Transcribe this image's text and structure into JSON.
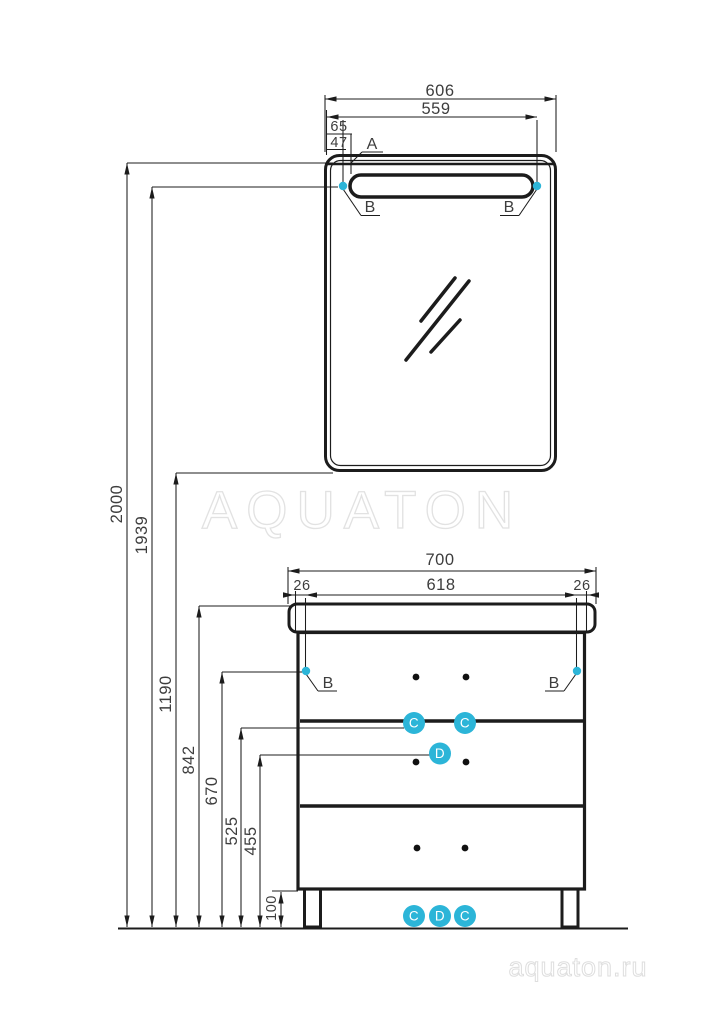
{
  "brand": {
    "watermark_center": "AQUATON",
    "watermark_corner": "aquaton.ru"
  },
  "colors": {
    "accent_cyan": "#2cb5d8",
    "line_black": "#1c1c1c",
    "watermark_gray": "#e2e2e2"
  },
  "callouts": {
    "a": "A",
    "b": "B",
    "c": "C",
    "d": "D"
  },
  "mirror_dims": {
    "overall_width": "606",
    "lamp_span": "559",
    "edge_to_lamp": "65",
    "edge_to_point": "47"
  },
  "vanity_dims": {
    "overall_width": "700",
    "inner_span": "618",
    "side_left": "26",
    "side_right": "26"
  },
  "height_dims": {
    "overall": "2000",
    "lamp_point": "1939",
    "mirror_bottom": "1190",
    "countertop": "842",
    "side_point": "670",
    "upper_point": "525",
    "lower_point": "455",
    "leg": "100"
  }
}
